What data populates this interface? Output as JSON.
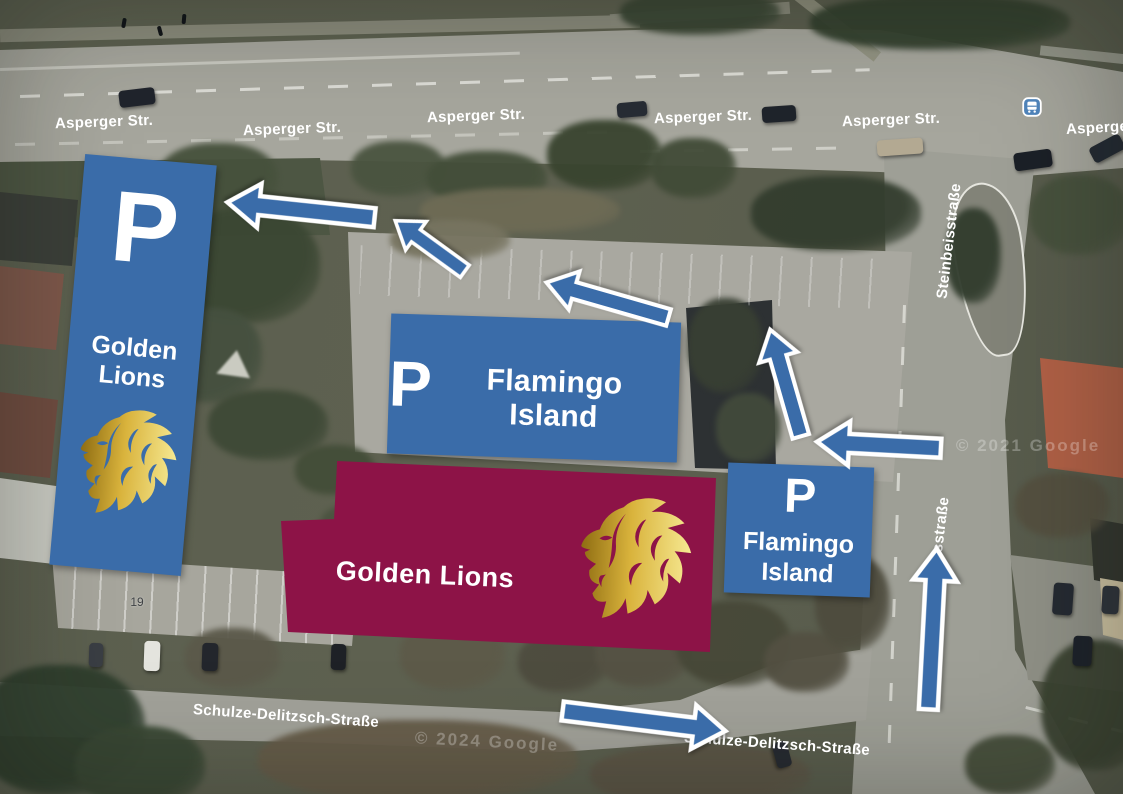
{
  "colors": {
    "overlay_blue": "#3a6ca9",
    "building_maroon": "#8d1347",
    "gold_dark": "#8f6d12",
    "gold_mid": "#d9b33c",
    "gold_light": "#f6e992"
  },
  "map": {
    "street_labels": [
      {
        "text": "Asperger Str.",
        "x": 104,
        "y": 122,
        "rot": -2
      },
      {
        "text": "Asperger Str.",
        "x": 292,
        "y": 129,
        "rot": -2
      },
      {
        "text": "Asperger Str.",
        "x": 476,
        "y": 116,
        "rot": -2
      },
      {
        "text": "Asperger Str.",
        "x": 703,
        "y": 117,
        "rot": -2
      },
      {
        "text": "Asperger Str.",
        "x": 891,
        "y": 120,
        "rot": -2
      },
      {
        "text": "Asperger Str.",
        "x": 1066,
        "y": 127,
        "rot": -3,
        "anchor": "left"
      },
      {
        "text": "Steinbeisstraße",
        "x": 949,
        "y": 241,
        "rot": -83
      },
      {
        "text": "eisstraße",
        "x": 940,
        "y": 531,
        "rot": -83
      },
      {
        "text": "Schulze-Delitzsch-Straße",
        "x": 286,
        "y": 716,
        "rot": 4
      },
      {
        "text": "Schulze-Delitzsch-Straße",
        "x": 777,
        "y": 744,
        "rot": 4
      }
    ],
    "house_number": {
      "text": "19",
      "x": 137,
      "y": 602
    },
    "watermarks": [
      {
        "text": "© 2021 Google",
        "x": 1028,
        "y": 446,
        "rot": 0
      },
      {
        "text": "© 2024 Google",
        "x": 487,
        "y": 742,
        "rot": 3
      }
    ],
    "bus_stop": {
      "x": 1032,
      "y": 107
    }
  },
  "overlays": {
    "parking_left": {
      "p": "P",
      "line1": "Golden",
      "line2": "Lions"
    },
    "parking_middle": {
      "p": "P",
      "label": "Flamingo Island"
    },
    "parking_right": {
      "p": "P",
      "line1": "Flamingo",
      "line2": "Island"
    },
    "building": {
      "label": "Golden Lions"
    }
  },
  "arrows": [
    {
      "name": "exit-to-asperger-arrow",
      "x": 301,
      "y": 210,
      "len": 148,
      "angle": 186,
      "t": 1
    },
    {
      "name": "turn-up-left-arrow",
      "x": 430,
      "y": 246,
      "len": 86,
      "angle": 216,
      "t": 0.8
    },
    {
      "name": "parking-lot-west-arrow",
      "x": 607,
      "y": 300,
      "len": 127,
      "angle": 196,
      "t": 0.9
    },
    {
      "name": "entry-north-arrow",
      "x": 785,
      "y": 383,
      "len": 111,
      "angle": 254,
      "t": 0.9
    },
    {
      "name": "entry-west-arrow",
      "x": 879,
      "y": 445,
      "len": 124,
      "angle": 183,
      "t": 1
    },
    {
      "name": "steinbeis-north-arrow",
      "x": 932,
      "y": 629,
      "len": 161,
      "angle": 273,
      "t": 1
    },
    {
      "name": "schulze-east-arrow",
      "x": 644,
      "y": 721,
      "len": 164,
      "angle": 7,
      "t": 1
    }
  ]
}
